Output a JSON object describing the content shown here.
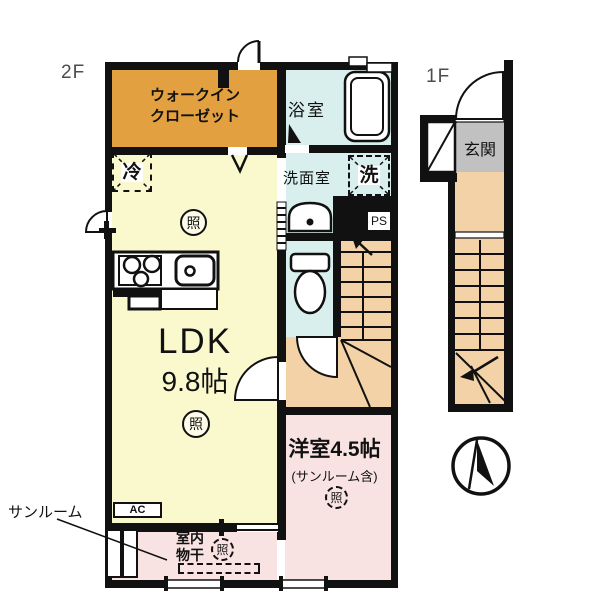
{
  "floors": {
    "second": "2F",
    "first": "1F"
  },
  "rooms": {
    "walkin_closet_line1": "ウォークイン",
    "walkin_closet_line2": "クローゼット",
    "bathroom": "浴室",
    "washroom": "洗面室",
    "entrance": "玄関",
    "ldk_label": "LDK",
    "ldk_size": "9.8帖",
    "western_label": "洋室4.5帖",
    "western_note": "(サンルーム含)",
    "sunroom_label": "サンルーム",
    "indoor_drying_line1": "室内",
    "indoor_drying_line2": "物干"
  },
  "symbols": {
    "refrigerator": "冷",
    "washer": "洗",
    "light": "照",
    "pipe_space": "PS",
    "air_conditioner": "AC"
  },
  "colors": {
    "closet": "#E2A040",
    "ldk": "#FAF8CD",
    "wet_area": "#D8EFED",
    "stairs": "#F3D2A7",
    "pink": "#F9E3E2",
    "entrance": "#C1C1C1",
    "wall": "#111111"
  }
}
